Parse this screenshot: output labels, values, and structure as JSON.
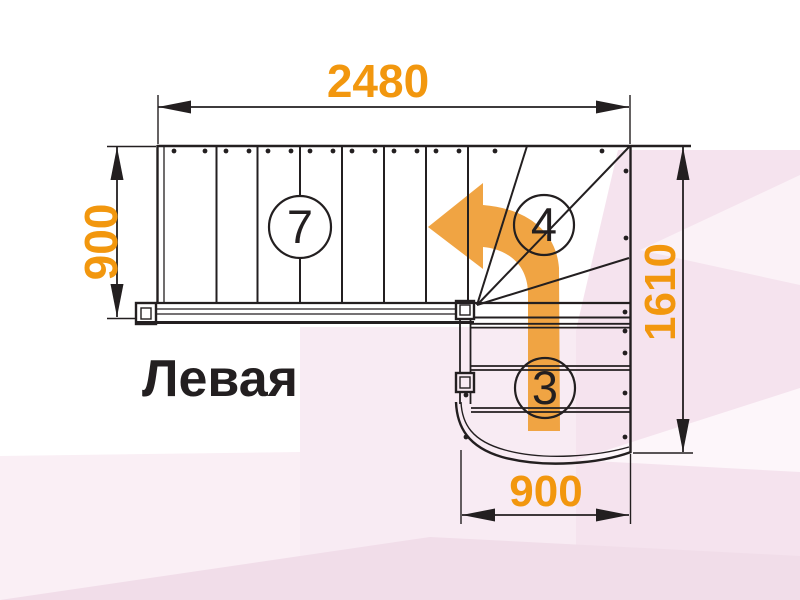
{
  "diagram": {
    "type": "staircase-plan",
    "variant_label": "Левая",
    "dimensions": {
      "top_width": "2480",
      "left_depth": "900",
      "right_height": "1610",
      "bottom_width": "900"
    },
    "step_counts": {
      "upper_flight": "7",
      "winder_turn": "4",
      "lower_flight": "3"
    },
    "arrow_direction": "turn-left-up",
    "colors": {
      "dimension_orange": "#F2970E",
      "arrow_orange": "#F0A443",
      "line_black": "#231F20",
      "bg_pink_right": "#F5E3EE",
      "bg_pink_mid": "#F8EBF3",
      "bg_pink_left": "#FAEFF5",
      "bg_pink_bottom": "#F1DDE9"
    }
  }
}
